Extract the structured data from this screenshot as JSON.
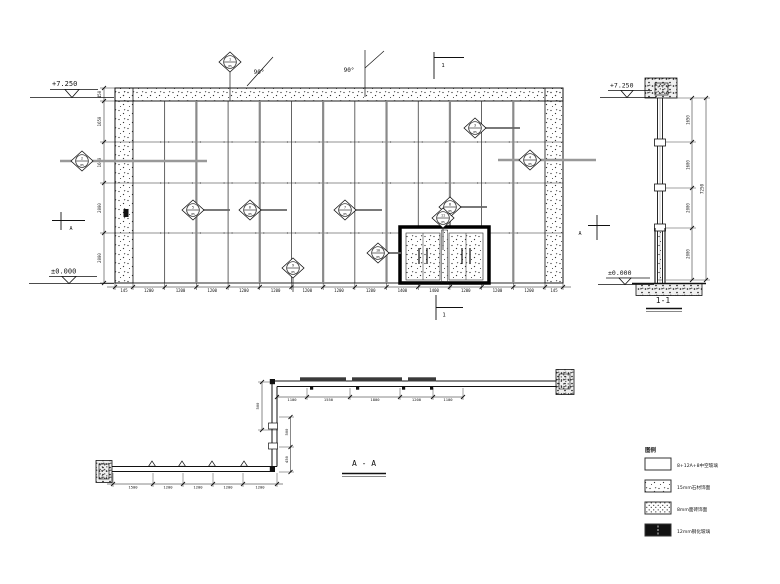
{
  "drawing": {
    "elevation": {
      "level_top": "+7.250",
      "level_bottom": "±0.000",
      "angle_label_1": "90°",
      "angle_label_2": "90°",
      "section_flag_top": "1",
      "section_flag_bottom": "1",
      "section_flag_left": "A",
      "section_flag_right": "A",
      "left_dims": [
        "450",
        "1650",
        "1600",
        "2000",
        "2000"
      ],
      "bottom_dims": [
        "145",
        "1200",
        "1200",
        "1200",
        "1200",
        "1200",
        "1200",
        "1200",
        "1200",
        "1400",
        "1400",
        "1200",
        "1200",
        "1200",
        "145"
      ],
      "callouts": [
        {
          "top": "1",
          "bottom": "05"
        },
        {
          "top": "2",
          "bottom": "05"
        },
        {
          "top": "3",
          "bottom": "05"
        },
        {
          "top": "4",
          "bottom": "05"
        },
        {
          "top": "5",
          "bottom": "05"
        },
        {
          "top": "6",
          "bottom": "05"
        },
        {
          "top": "7",
          "bottom": "05"
        },
        {
          "top": "8",
          "bottom": "05"
        },
        {
          "top": "9",
          "bottom": "05"
        },
        {
          "top": "10",
          "bottom": "05"
        },
        {
          "top": "11",
          "bottom": "05"
        }
      ]
    },
    "section_1_1": {
      "title": "1-1",
      "level_top": "+7.250",
      "level_bottom": "±0.000",
      "segment_dims": [
        "1650",
        "1600",
        "2000",
        "2000"
      ],
      "overall_dim": "7250"
    },
    "plan_a_a": {
      "title": "A - A",
      "top_dims": [
        "1100",
        "1550",
        "1800",
        "1200",
        "1100"
      ],
      "upper_left_dim": "500",
      "right_dims": [
        "500",
        "450"
      ],
      "bottom_dims": [
        "1500",
        "1200",
        "1200",
        "1200",
        "1200"
      ]
    },
    "legend": {
      "title": "图例",
      "items": [
        {
          "swatch": "insulated-glass",
          "label": "8+12A+8中空玻璃"
        },
        {
          "swatch": "stone-sparse",
          "label": "15mm石材饰面"
        },
        {
          "swatch": "stone-dense",
          "label": "8mm面砖饰面"
        },
        {
          "swatch": "tempered-glass",
          "label": "12mm钢化玻璃"
        }
      ]
    }
  }
}
